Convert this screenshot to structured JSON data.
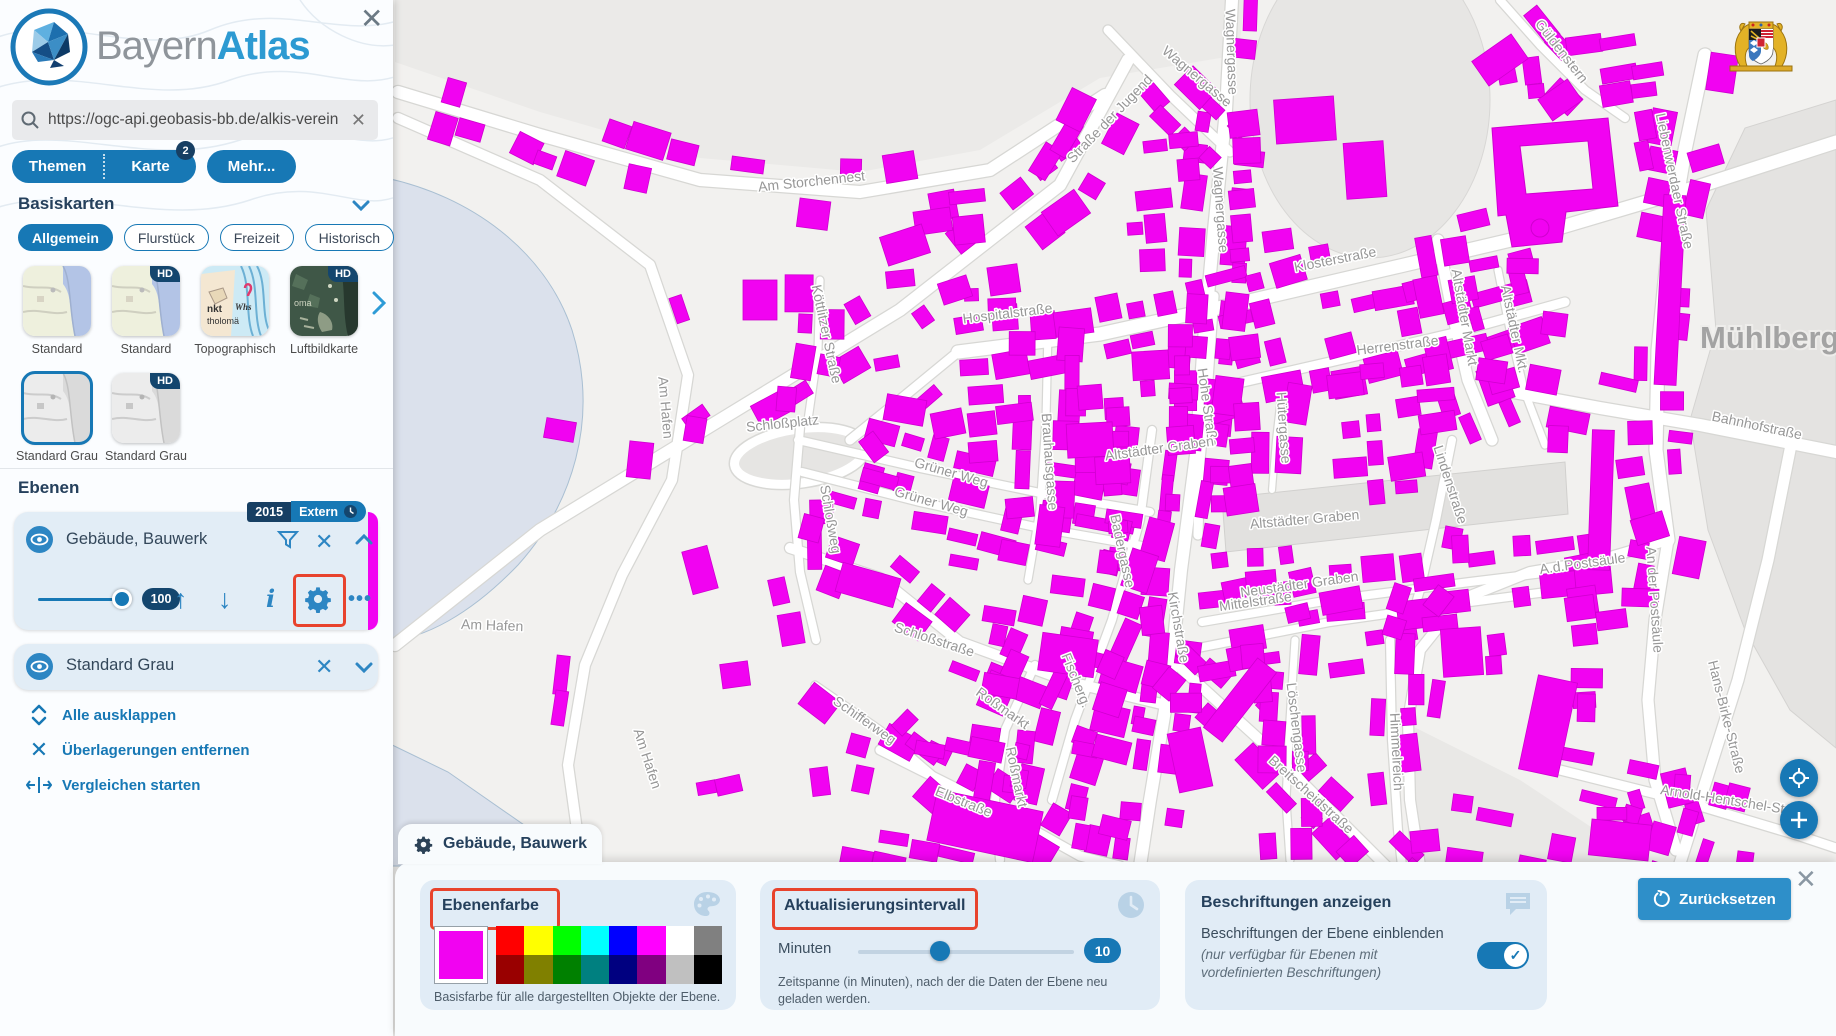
{
  "brand": {
    "bayern": "Bayern",
    "atlas": "Atlas"
  },
  "search": {
    "value": "https://ogc-api.geobasis-bb.de/alkis-verein"
  },
  "tabs": {
    "themen": "Themen",
    "karte": "Karte",
    "karte_badge": "2",
    "mehr": "Mehr..."
  },
  "basemaps": {
    "heading": "Basiskarten",
    "hd_badge": "HD",
    "filters": [
      {
        "label": "Allgemein",
        "selected": true
      },
      {
        "label": "Flurstück",
        "selected": false
      },
      {
        "label": "Freizeit",
        "selected": false
      },
      {
        "label": "Historisch",
        "selected": false
      }
    ],
    "row1": [
      {
        "label": "Standard",
        "type": "standard",
        "hd": false
      },
      {
        "label": "Standard",
        "type": "standard",
        "hd": true
      },
      {
        "label": "Topographisch",
        "type": "topo",
        "hd": false
      },
      {
        "label": "Luftbildkarte",
        "type": "aerial",
        "hd": true
      }
    ],
    "row2": [
      {
        "label": "Standard Grau",
        "type": "gray",
        "hd": false,
        "selected": true
      },
      {
        "label": "Standard Grau",
        "type": "gray",
        "hd": true,
        "selected": false
      }
    ]
  },
  "layers": {
    "heading": "Ebenen",
    "layer1": {
      "title": "Gebäude, Bauwerk",
      "badge_year": "2015",
      "badge_extern": "Extern",
      "opacity": "100",
      "color": "#f103f1"
    },
    "layer2": {
      "title": "Standard Grau"
    },
    "actions": [
      {
        "label": "Alle ausklappen",
        "icon": "expand"
      },
      {
        "label": "Überlagerungen entfernen",
        "icon": "close"
      },
      {
        "label": "Vergleichen starten",
        "icon": "compare"
      }
    ]
  },
  "panel": {
    "tab_title": "Gebäude, Bauwerk",
    "color_card": {
      "title": "Ebenenfarbe",
      "caption": "Basisfarbe für alle dargestellten Objekte der Ebene.",
      "selected_color": "#f103f1",
      "palette_row1": [
        "#ff0000",
        "#ffff00",
        "#00ff00",
        "#00ffff",
        "#0000ff",
        "#ff00ff",
        "#ffffff",
        "#808080"
      ],
      "palette_row2": [
        "#990000",
        "#808000",
        "#008000",
        "#008080",
        "#000080",
        "#800080",
        "#c0c0c0",
        "#000000"
      ]
    },
    "interval_card": {
      "title": "Aktualisierungsintervall",
      "unit_label": "Minuten",
      "value": "10",
      "caption": "Zeitspanne (in Minuten), nach der die Daten der Ebene neu geladen werden."
    },
    "labels_card": {
      "title": "Beschriftungen anzeigen",
      "line1": "Beschriftungen der Ebene einblenden",
      "line2": "(nur verfügbar für Ebenen mit vordefinierten Beschriftungen)"
    },
    "reset_label": "Zurücksetzen"
  },
  "map": {
    "town_label": "Mühlberg",
    "building_color": "#f103f1",
    "street_labels": [
      {
        "t": "Am Storchennest",
        "x": 812,
        "y": 186,
        "r": -6
      },
      {
        "t": "Wagnergasse",
        "x": 1194,
        "y": 80,
        "r": 40
      },
      {
        "t": "Wagnergasse",
        "x": 1227,
        "y": 52,
        "r": 88
      },
      {
        "t": "Wagnergasse",
        "x": 1216,
        "y": 210,
        "r": 86
      },
      {
        "t": "Straße der Jugend",
        "x": 1113,
        "y": 122,
        "r": -46
      },
      {
        "t": "Klosterstraße",
        "x": 1336,
        "y": 264,
        "r": -11
      },
      {
        "t": "Hospitalstraße",
        "x": 1008,
        "y": 318,
        "r": -7
      },
      {
        "t": "Herrenstraße",
        "x": 1398,
        "y": 350,
        "r": -7
      },
      {
        "t": "Hohe Straße",
        "x": 1203,
        "y": 408,
        "r": 82
      },
      {
        "t": "Hütergasse",
        "x": 1279,
        "y": 428,
        "r": 86
      },
      {
        "t": "Altstädter Graben",
        "x": 1160,
        "y": 453,
        "r": -8
      },
      {
        "t": "Altstädter Graben",
        "x": 1305,
        "y": 524,
        "r": -5
      },
      {
        "t": "Neustädter Graben",
        "x": 1300,
        "y": 589,
        "r": -8
      },
      {
        "t": "Mittelstraße",
        "x": 1256,
        "y": 606,
        "r": -8
      },
      {
        "t": "Kirchstraße",
        "x": 1174,
        "y": 628,
        "r": 80
      },
      {
        "t": "Brauhausgasse",
        "x": 1045,
        "y": 462,
        "r": 86
      },
      {
        "t": "Badergasse",
        "x": 1118,
        "y": 552,
        "r": 78
      },
      {
        "t": "Fischerg.",
        "x": 1072,
        "y": 682,
        "r": 68
      },
      {
        "t": "Grüner Weg",
        "x": 950,
        "y": 477,
        "r": 16
      },
      {
        "t": "Grüner Weg",
        "x": 930,
        "y": 506,
        "r": 16
      },
      {
        "t": "Köttlitzer Straße",
        "x": 822,
        "y": 335,
        "r": 78
      },
      {
        "t": "Schloßweg",
        "x": 826,
        "y": 520,
        "r": 80
      },
      {
        "t": "Schloßplatz",
        "x": 783,
        "y": 428,
        "r": -6
      },
      {
        "t": "Schloßstraße",
        "x": 933,
        "y": 644,
        "r": 18
      },
      {
        "t": "Roßmarkt",
        "x": 1000,
        "y": 712,
        "r": 35
      },
      {
        "t": "Roßmarkt",
        "x": 1012,
        "y": 778,
        "r": 78
      },
      {
        "t": "Elbstraße",
        "x": 962,
        "y": 806,
        "r": 22
      },
      {
        "t": "Schifferweg",
        "x": 862,
        "y": 724,
        "r": 35
      },
      {
        "t": "Am Hafen",
        "x": 661,
        "y": 408,
        "r": 85
      },
      {
        "t": "Am Hafen",
        "x": 492,
        "y": 630,
        "r": 2
      },
      {
        "t": "Am Hafen",
        "x": 643,
        "y": 760,
        "r": 72
      },
      {
        "t": "Breitscheidstraße",
        "x": 1308,
        "y": 798,
        "r": 42
      },
      {
        "t": "Löschengasse",
        "x": 1292,
        "y": 728,
        "r": 83
      },
      {
        "t": "Himmelreich",
        "x": 1392,
        "y": 752,
        "r": 87
      },
      {
        "t": "Lindenstraße",
        "x": 1446,
        "y": 486,
        "r": 72
      },
      {
        "t": "Altstädter Markt",
        "x": 1460,
        "y": 318,
        "r": 80
      },
      {
        "t": "Altstädter Mkt.",
        "x": 1510,
        "y": 330,
        "r": 78
      },
      {
        "t": "Liebenwerdaer Straße",
        "x": 1670,
        "y": 182,
        "r": 78
      },
      {
        "t": "Güldenstern",
        "x": 1558,
        "y": 54,
        "r": 52
      },
      {
        "t": "Bahnhofstraße",
        "x": 1756,
        "y": 430,
        "r": 12
      },
      {
        "t": "A.d.Postsäule",
        "x": 1583,
        "y": 568,
        "r": -8
      },
      {
        "t": "An der Postsäule",
        "x": 1650,
        "y": 600,
        "r": 86
      },
      {
        "t": "Hans-Birke-Straße",
        "x": 1722,
        "y": 718,
        "r": 76
      },
      {
        "t": "Arnold-Hentschel-Straße",
        "x": 1736,
        "y": 806,
        "r": 9
      }
    ]
  }
}
